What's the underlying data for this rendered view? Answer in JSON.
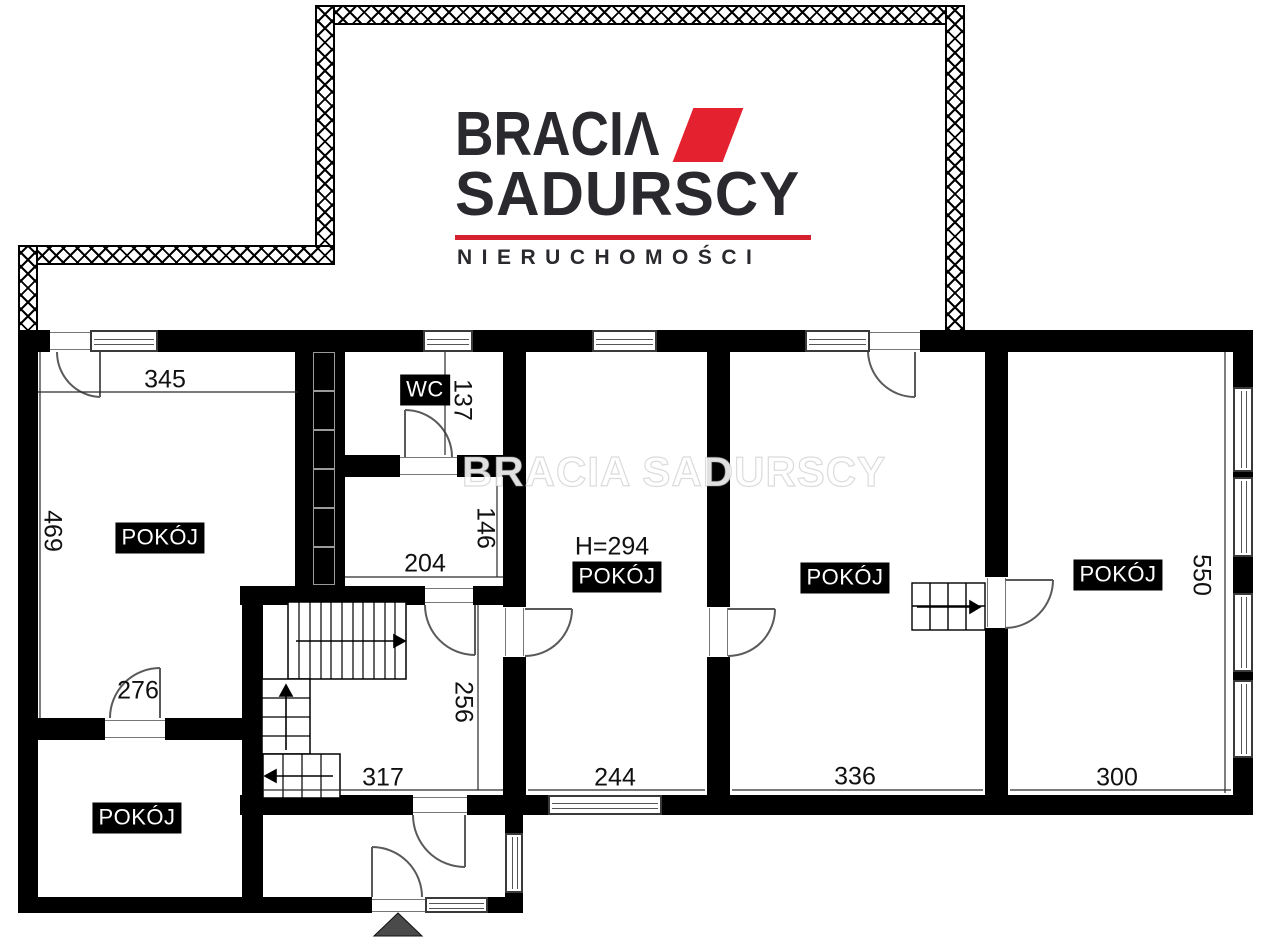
{
  "logo": {
    "brand_line1": "BRACIΛ",
    "brand_line2": "SADURSCY",
    "tagline": "NIERUCHOMOŚCI",
    "accent_color": "#e4212e",
    "text_color": "#2a292d"
  },
  "watermark": "BRACIA SADURSCY",
  "plan": {
    "room_labels": {
      "room_top_left": "POKÓJ",
      "room_center": "POKÓJ",
      "room_right_mid": "POKÓJ",
      "room_far_right": "POKÓJ",
      "room_bottom_left": "POKÓJ",
      "wc": "WC"
    },
    "height_note": "H=294",
    "dimensions": {
      "d345": "345",
      "d469": "469",
      "d137": "137",
      "d146": "146",
      "d204": "204",
      "d256": "256",
      "d317": "317",
      "d276": "276",
      "d244": "244",
      "d336": "336",
      "d300": "300",
      "d550": "550"
    }
  }
}
